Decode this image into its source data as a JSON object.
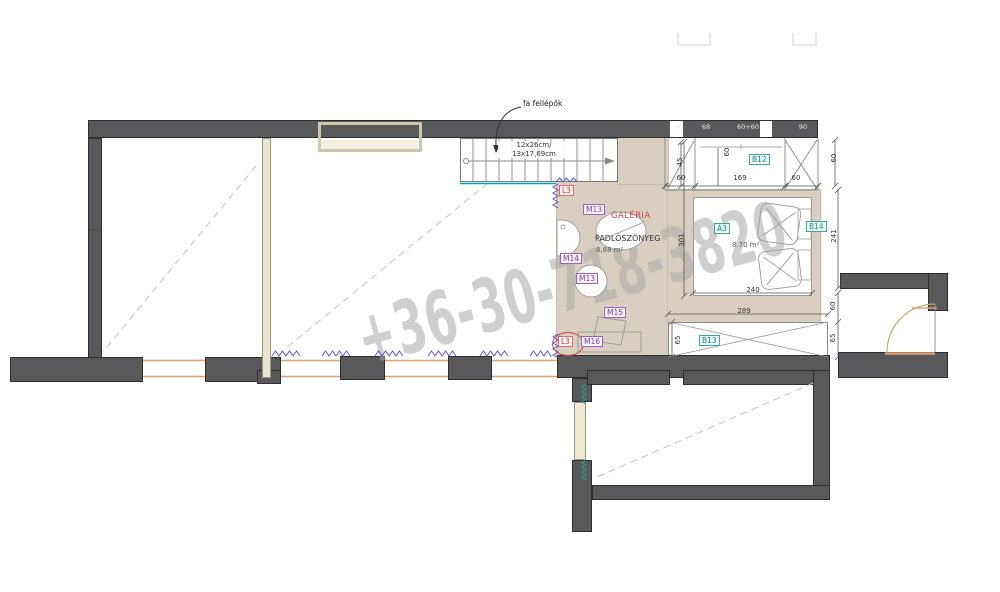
{
  "watermark": {
    "text": "+36-30-718-3820"
  },
  "annotations": {
    "stairs_note": "fa fellépők",
    "stairs_dim_line1": "12x26cm/",
    "stairs_dim_line2": "13x17,69cm",
    "galeria_label": "GALÉRIA",
    "floor_finish_label": "PADLÓSZŐNYEG",
    "galeria_area": "8,88 m²",
    "room_a3_code": "A3",
    "room_a3_area": "8.70 m²"
  },
  "markers": {
    "m13_upper": "M13",
    "m13_lower": "M13",
    "m14": "M14",
    "m15": "M15",
    "m16": "M16",
    "l3_upper": "L3",
    "l3_lower": "L3",
    "b12": "B12",
    "b13": "B13",
    "b14": "B14"
  },
  "dimensions": {
    "v45": "45",
    "v60_cabinet": "60",
    "h60_left": "60",
    "h169": "169",
    "h60_right": "60",
    "v60_outer_top": "60",
    "v301": "301",
    "v241": "241",
    "h240": "240",
    "h289": "289",
    "v65_left": "65",
    "v60_right": "60",
    "v65_right": "65"
  },
  "wall_texts": {
    "w1": "40",
    "w2": "68",
    "w3": "60+60",
    "w4": "90"
  },
  "colors": {
    "wall": "#59595b",
    "floor": "#d9cfc0",
    "teal_accent": "#0d8f85",
    "purple_accent": "#8232a8",
    "red_accent": "#cc3b3b",
    "window": "#e0a070",
    "zigzag_purple": "#5a55cc",
    "zigzag_teal": "#2a9d8f",
    "watermark": "#a8a8a8"
  }
}
